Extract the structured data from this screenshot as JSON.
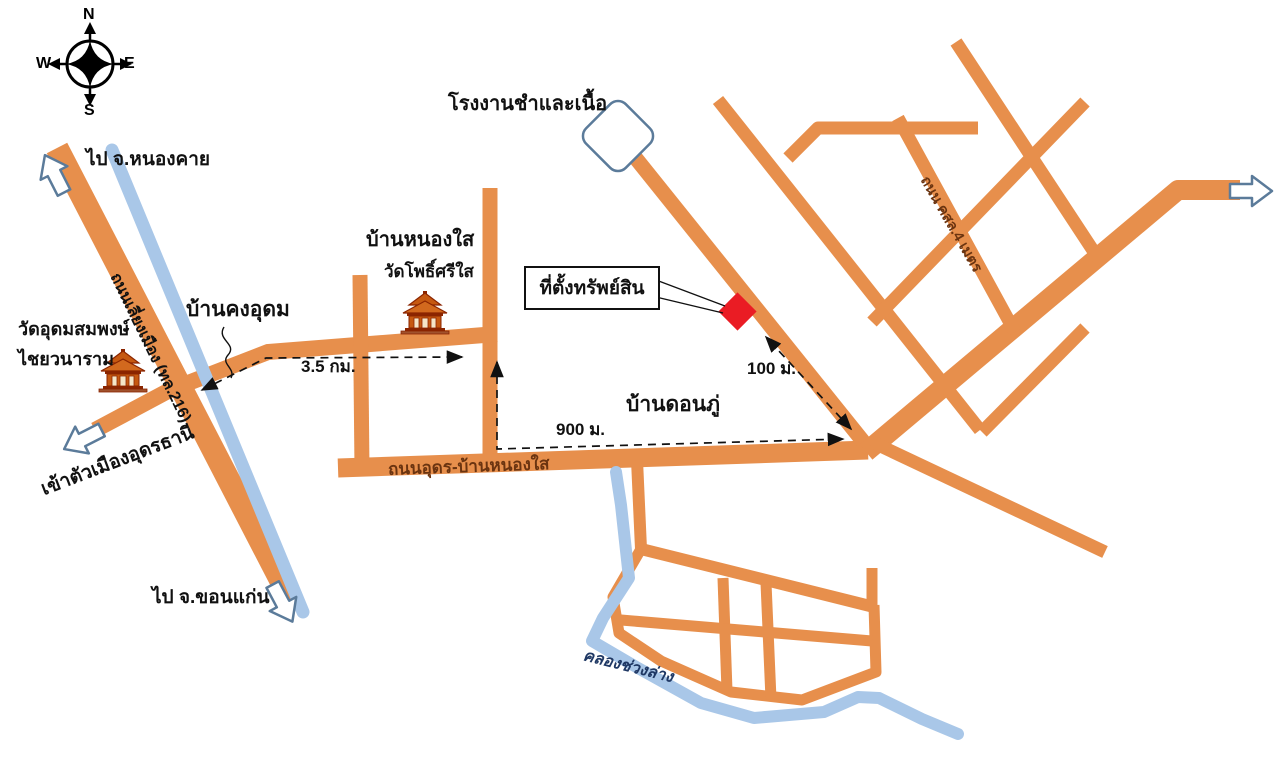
{
  "compass": {
    "n": "N",
    "e": "E",
    "s": "S",
    "w": "W"
  },
  "labels": {
    "to_nongkhai": "ไป จ.หนองคาย",
    "to_khonkaen": "ไป จ.ขอนแก่น",
    "to_udon_city": "เข้าตัวเมืองอุดรธานี",
    "bypass_road": "ถนนเลี่ยงเมือง (ทล.216)",
    "factory": "โรงงานชำและเนื้อ",
    "ban_nong_sai": "บ้านหนองใส",
    "wat_pho_si_sai": "วัดโพธิ์ศรีใส",
    "wat_udom_line1": "วัดอุดมสมพงษ์",
    "wat_udom_line2": "ไชยวนาราม",
    "ban_khong_udom": "บ้านคงอุดม",
    "ban_don_phu": "บ้านดอนภู่",
    "property": "ที่ตั้งทรัพย์สิน",
    "udon_nongsai_road": "ถนนอุดร-บ้านหนองใส",
    "csl_road": "ถนน คสล.4 เมตร",
    "khlong": "คลองช่วงล่าง"
  },
  "distances": {
    "d100": "100 ม.",
    "d900": "900 ม.",
    "d35": "3.5 กม."
  },
  "colors": {
    "road": "#E78F4C",
    "water": "#A9C7E8",
    "marker": "#EA1C24",
    "arrow_outline": "#5B7B9A",
    "road_text": "#6B3410",
    "water_text": "#1F3864"
  }
}
